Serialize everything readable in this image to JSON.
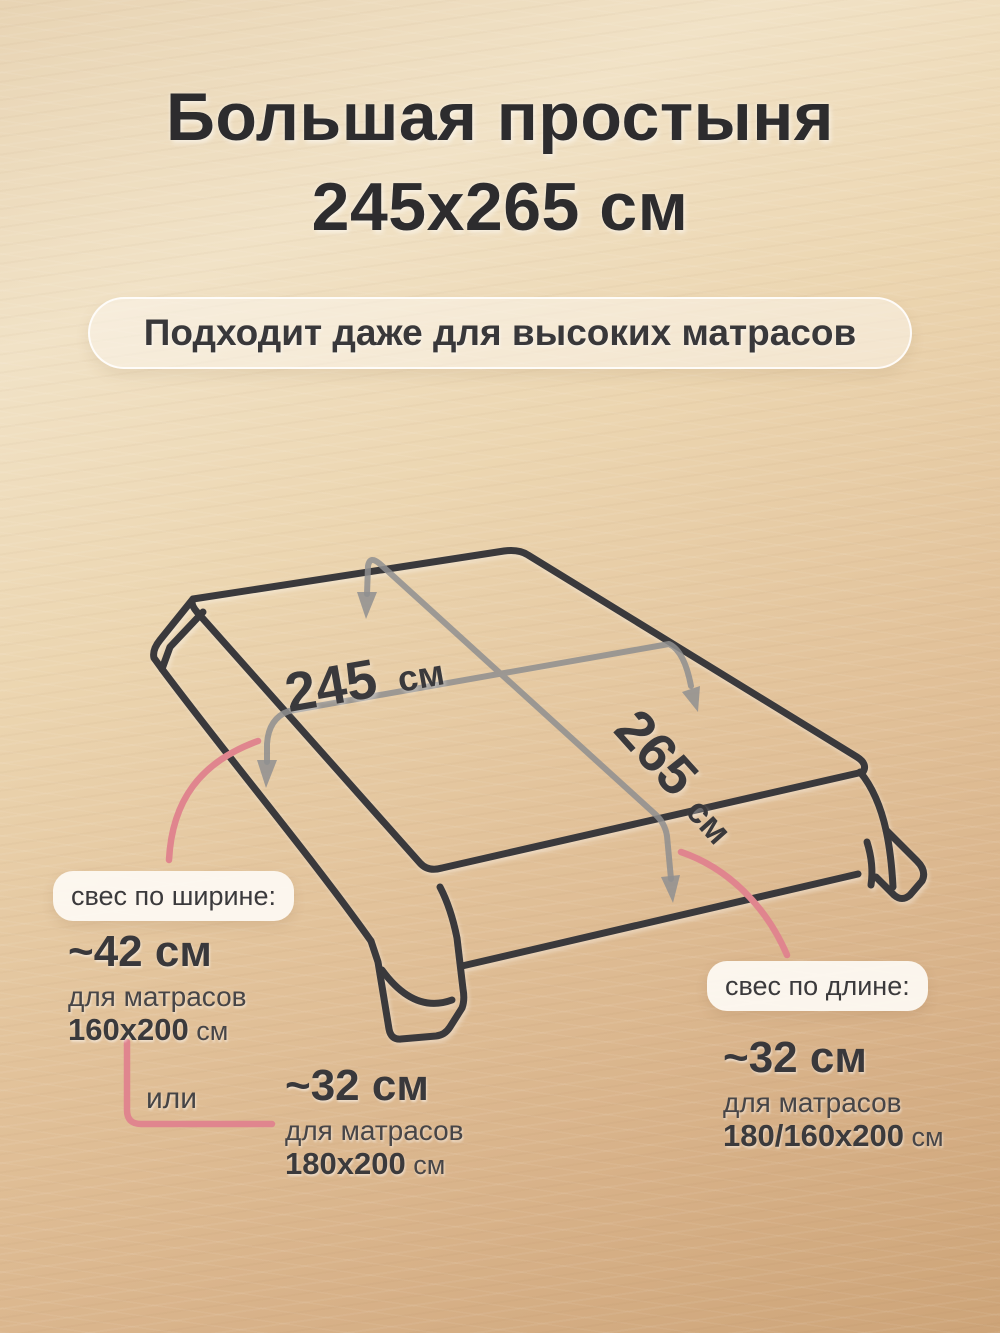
{
  "title": {
    "line1": "Большая простыня",
    "line2": "245х265 см"
  },
  "subtitle": "Подходит даже для высоких матрасов",
  "diagram": {
    "width_value": "245",
    "width_unit": "см",
    "length_value": "265",
    "length_unit": "см"
  },
  "annotations": {
    "width_overhang": {
      "label": "свес по ширине:",
      "value": "~42 см",
      "desc": "для матрасов",
      "size_bold": "160х200",
      "size_unit": "см"
    },
    "or_label": "или",
    "alt_overhang": {
      "value": "~32 см",
      "desc": "для матрасов",
      "size_bold": "180х200",
      "size_unit": "см"
    },
    "length_overhang": {
      "label": "свес по длине:",
      "value": "~32 см",
      "desc": "для матрасов",
      "size_bold": "180/160х200",
      "size_unit": "см"
    }
  },
  "colors": {
    "accent_pink": "#e0858e",
    "line_dark": "#3a393c",
    "line_gray": "#8f8f90",
    "background_light": "#f1e2c6",
    "background_dark": "#cda478"
  }
}
